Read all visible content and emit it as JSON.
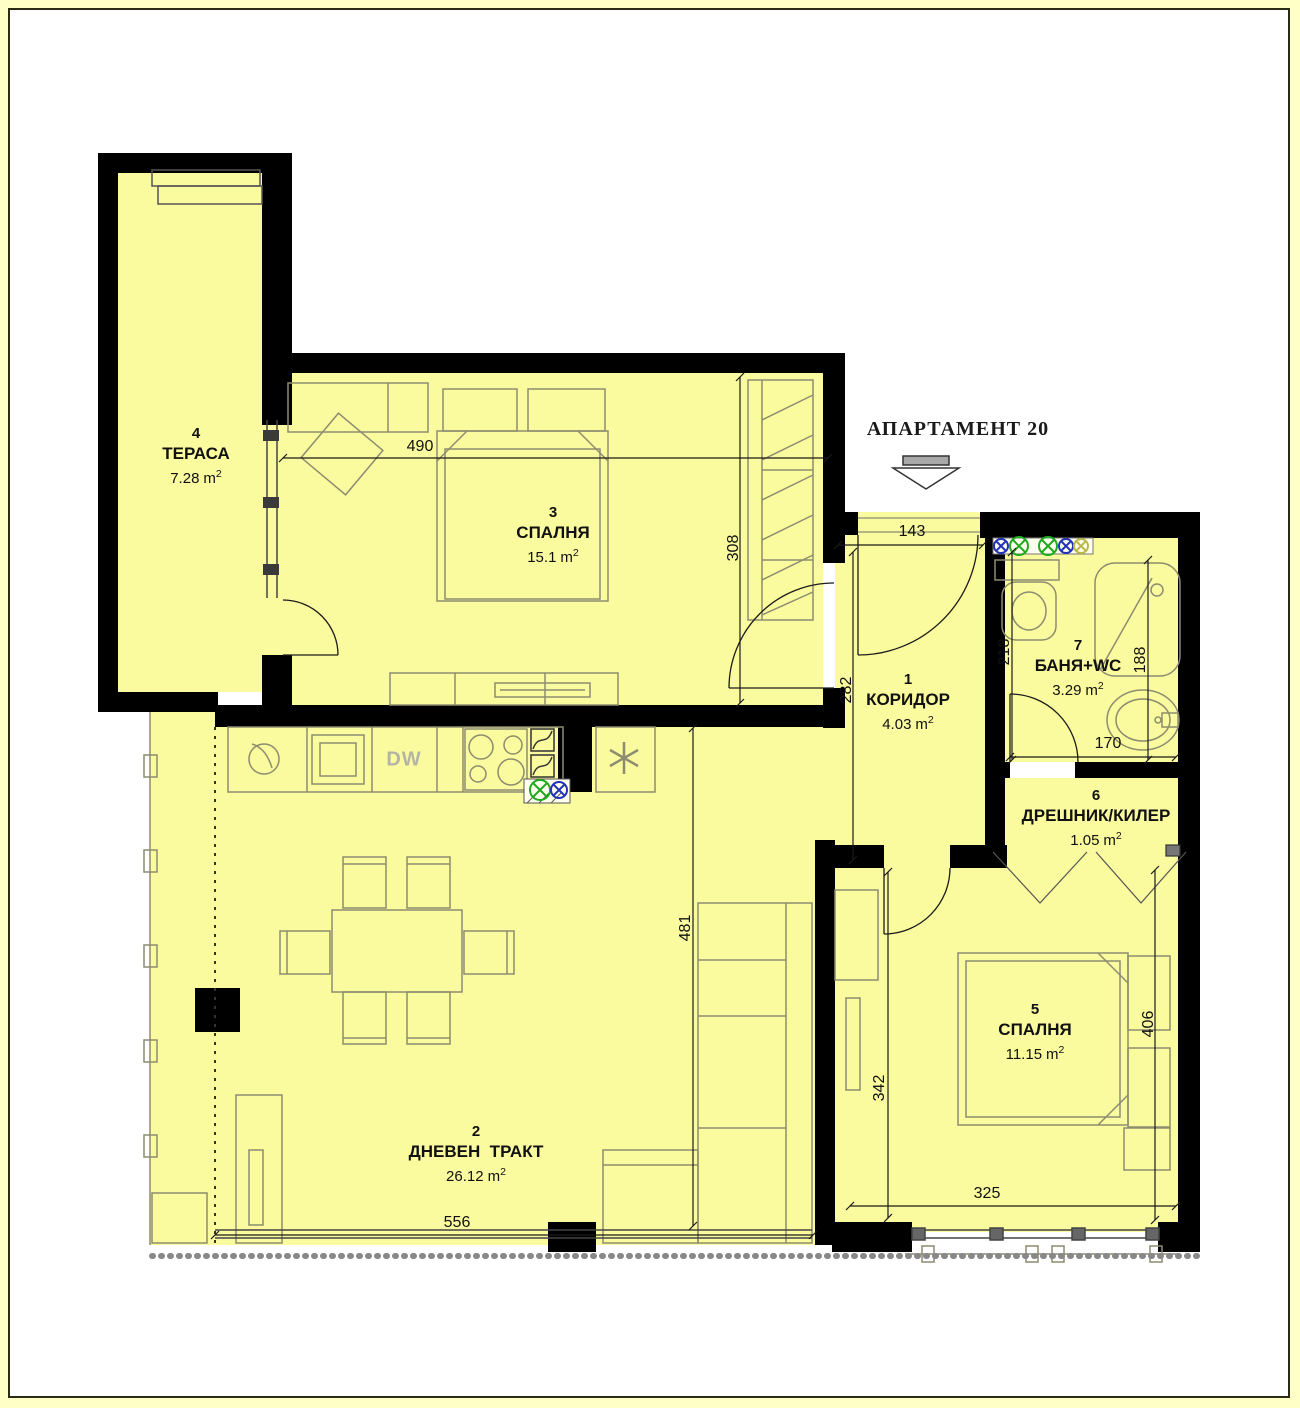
{
  "title": "АПАРТАМЕНТ 20",
  "units": {
    "meter": "m",
    "sup": "2"
  },
  "rooms": [
    {
      "number": "4",
      "name": "ТЕРАСА",
      "area": "7.28"
    },
    {
      "number": "3",
      "name": "СПАЛНЯ",
      "area": "15.1"
    },
    {
      "number": "1",
      "name": "КОРИДОР",
      "area": "4.03"
    },
    {
      "number": "7",
      "name": "БАНЯ+WC",
      "area": "3.29"
    },
    {
      "number": "6",
      "name": "ДРЕШНИК/КИЛЕР",
      "area": "1.05"
    },
    {
      "number": "5",
      "name": "СПАЛНЯ",
      "area": "11.15"
    },
    {
      "number": "2",
      "name": "ДНЕВЕН  ТРАКТ",
      "area": "26.12"
    }
  ],
  "dimensions": {
    "bedroom3_width": "490",
    "bedroom3_depth": "308",
    "entrance_width": "143",
    "corridor_depth": "282",
    "bathroom_left_depth": "218",
    "bathroom_right_depth": "188",
    "bathroom_width": "170",
    "living_depth": "481",
    "bedroom5_inner_depth": "342",
    "bedroom5_depth": "406",
    "bedroom5_width": "325",
    "living_width": "556"
  },
  "kitchen": {
    "dishwasher_label": "DW"
  },
  "colors": {
    "floor_fill": "#fafa9e",
    "wall": "#000000",
    "furniture_line": "#8c8c70",
    "page_margin": "#ffffc6",
    "symbol_green": "#1faa1f",
    "symbol_blue": "#2233bb"
  }
}
